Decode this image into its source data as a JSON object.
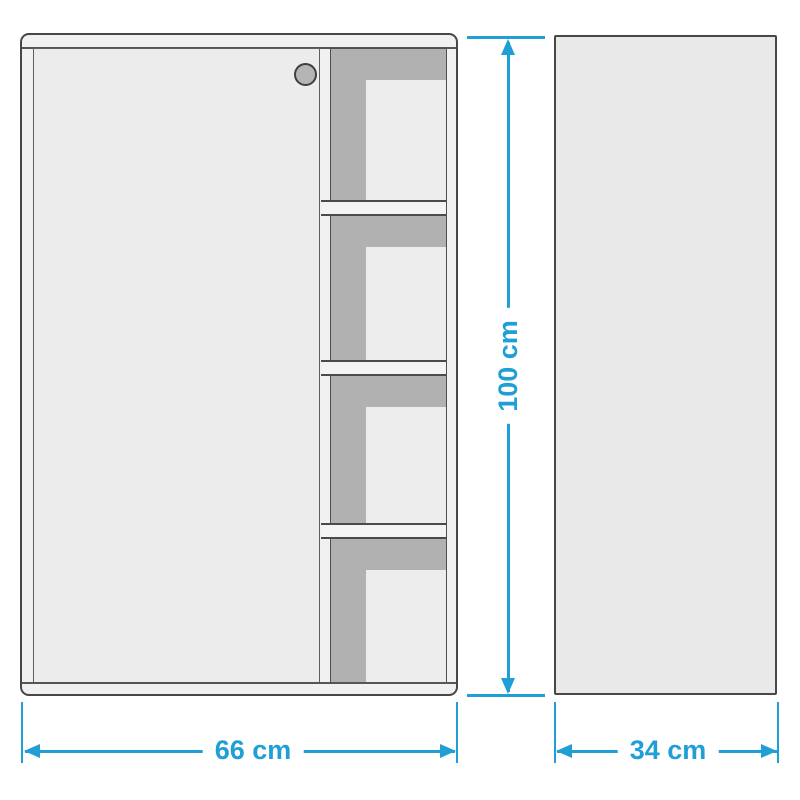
{
  "figure": {
    "type": "product-dimension-diagram",
    "accent_color": "#1f9fd6",
    "views": {
      "front": "cabinet-front-view",
      "side": "cabinet-side-view"
    },
    "dimensions": {
      "height_label": "100 cm",
      "width_label": "66 cm",
      "depth_label": "34 cm"
    }
  }
}
